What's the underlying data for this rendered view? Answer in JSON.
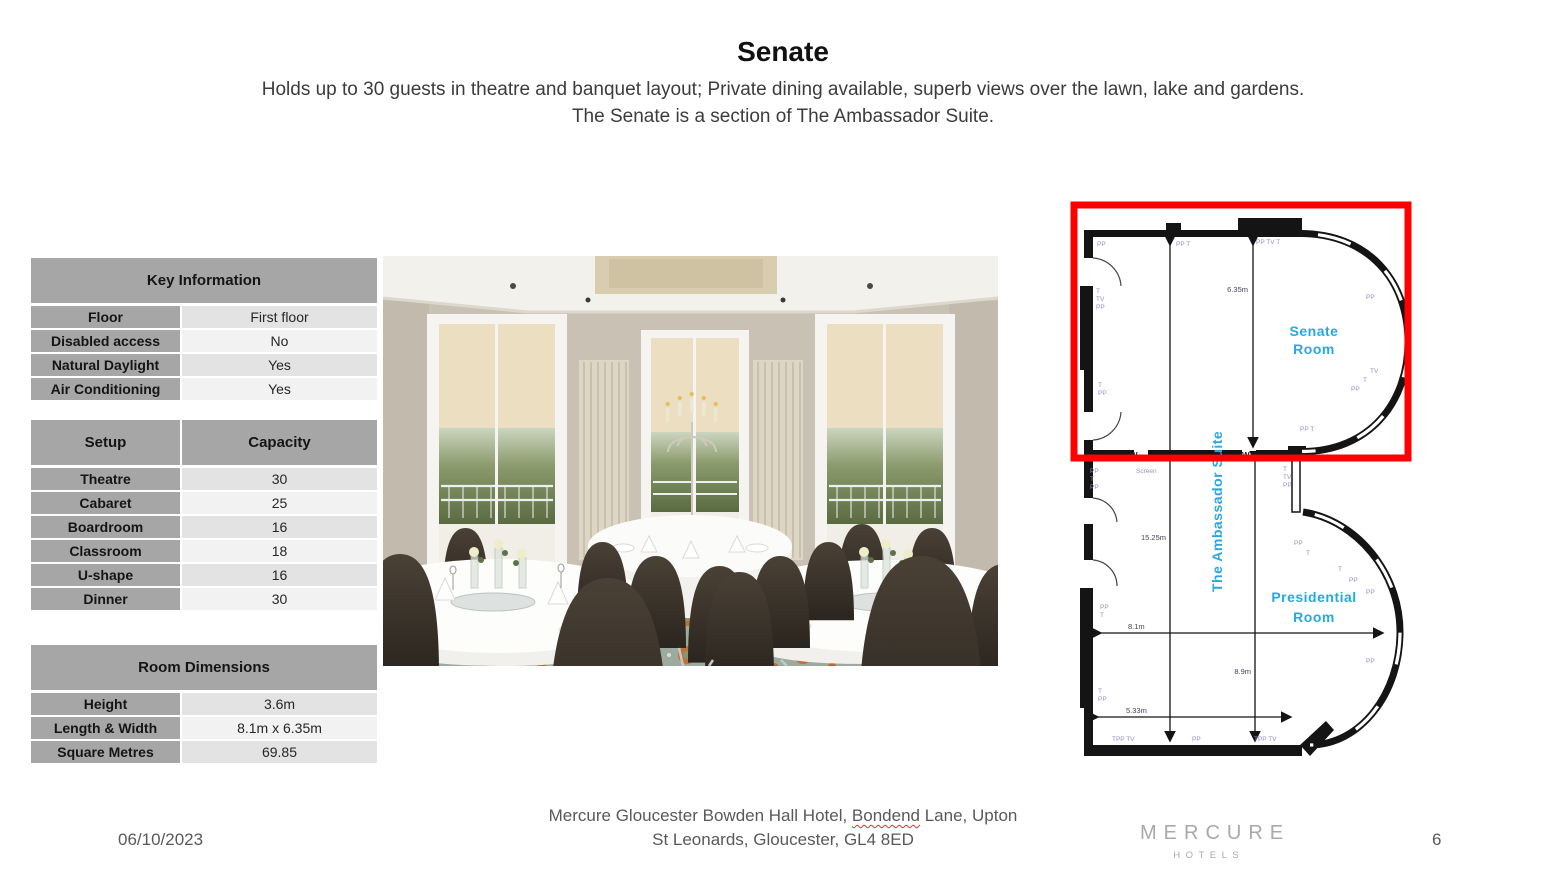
{
  "slide": {
    "title": "Senate",
    "subtitle_line1": "Holds up to 30 guests in theatre and banquet layout; Private dining available, superb views over the lawn, lake and gardens.",
    "subtitle_line2": "The Senate is a section of The Ambassador Suite."
  },
  "key_information": {
    "header": "Key Information",
    "rows": [
      {
        "label": "Floor",
        "value": "First floor"
      },
      {
        "label": "Disabled access",
        "value": "No"
      },
      {
        "label": "Natural Daylight",
        "value": "Yes"
      },
      {
        "label": "Air Conditioning",
        "value": "Yes"
      }
    ]
  },
  "setup_capacity": {
    "col1_header": "Setup",
    "col2_header": "Capacity",
    "rows": [
      {
        "label": "Theatre",
        "value": "30"
      },
      {
        "label": "Cabaret",
        "value": "25"
      },
      {
        "label": "Boardroom",
        "value": "16"
      },
      {
        "label": "Classroom",
        "value": "18"
      },
      {
        "label": "U-shape",
        "value": "16"
      },
      {
        "label": "Dinner",
        "value": "30"
      }
    ]
  },
  "room_dimensions": {
    "header": "Room Dimensions",
    "rows": [
      {
        "label": "Height",
        "value": "3.6m"
      },
      {
        "label": "Length & Width",
        "value": "8.1m x 6.35m"
      },
      {
        "label": "Square Metres",
        "value": "69.85"
      }
    ]
  },
  "floor_plan": {
    "senate_room_label_line1": "Senate",
    "senate_room_label_line2": "Room",
    "presidential_room_label_line1": "Presidential",
    "presidential_room_label_line2": "Room",
    "suite_label": "The Ambassador Suite",
    "dim_senate_depth": "6.35m",
    "dim_suite_length": "15.25m",
    "dim_presidential_depth": "8.9m",
    "dim_width": "8.1m",
    "dim_bottom_width": "5.33m",
    "partition_marks": [
      "W",
      "W"
    ],
    "room_label_color": "#29a8df",
    "highlight_color": "#fe0000",
    "marks": [
      {
        "x": 27,
        "y": 46,
        "t": "PP"
      },
      {
        "x": 106,
        "y": 46,
        "t": "PP T"
      },
      {
        "x": 186,
        "y": 44,
        "t": "PP TV T"
      },
      {
        "x": 26,
        "y": 93,
        "t": "T"
      },
      {
        "x": 26,
        "y": 101,
        "t": "TV"
      },
      {
        "x": 26,
        "y": 109,
        "t": "PP"
      },
      {
        "x": 296,
        "y": 99,
        "t": "PP"
      },
      {
        "x": 300,
        "y": 173,
        "t": "TV"
      },
      {
        "x": 293,
        "y": 182,
        "t": "T"
      },
      {
        "x": 281,
        "y": 191,
        "t": "PP"
      },
      {
        "x": 28,
        "y": 187,
        "t": "T"
      },
      {
        "x": 28,
        "y": 195,
        "t": "PP"
      },
      {
        "x": 230,
        "y": 231,
        "t": "PP T"
      },
      {
        "x": 20,
        "y": 273,
        "t": "PP"
      },
      {
        "x": 20,
        "y": 281,
        "t": "T"
      },
      {
        "x": 20,
        "y": 289,
        "t": "PP"
      },
      {
        "x": 66,
        "y": 273,
        "t": "Screen"
      },
      {
        "x": 213,
        "y": 271,
        "t": "T"
      },
      {
        "x": 213,
        "y": 279,
        "t": "TV"
      },
      {
        "x": 213,
        "y": 287,
        "t": "PP"
      },
      {
        "x": 224,
        "y": 345,
        "t": "PP"
      },
      {
        "x": 236,
        "y": 355,
        "t": "T"
      },
      {
        "x": 268,
        "y": 371,
        "t": "T"
      },
      {
        "x": 279,
        "y": 382,
        "t": "PP"
      },
      {
        "x": 296,
        "y": 394,
        "t": "PP"
      },
      {
        "x": 30,
        "y": 409,
        "t": "PP"
      },
      {
        "x": 30,
        "y": 417,
        "t": "T"
      },
      {
        "x": 296,
        "y": 463,
        "t": "PP"
      },
      {
        "x": 28,
        "y": 493,
        "t": "T"
      },
      {
        "x": 28,
        "y": 501,
        "t": "PP"
      },
      {
        "x": 42,
        "y": 541,
        "t": "TPP TV"
      },
      {
        "x": 122,
        "y": 541,
        "t": "PP"
      },
      {
        "x": 184,
        "y": 541,
        "t": "TPP TV"
      }
    ]
  },
  "footer": {
    "date": "06/10/2023",
    "address_line1_pre": "Mercure Gloucester Bowden Hall Hotel, ",
    "address_line1_misspelled": "Bondend",
    "address_line1_post": " Lane, Upton",
    "address_line2": "St Leonards, Gloucester, GL4 8ED",
    "brand_name": "MERCURE",
    "brand_sub": "HOTELS",
    "page_number": "6"
  }
}
